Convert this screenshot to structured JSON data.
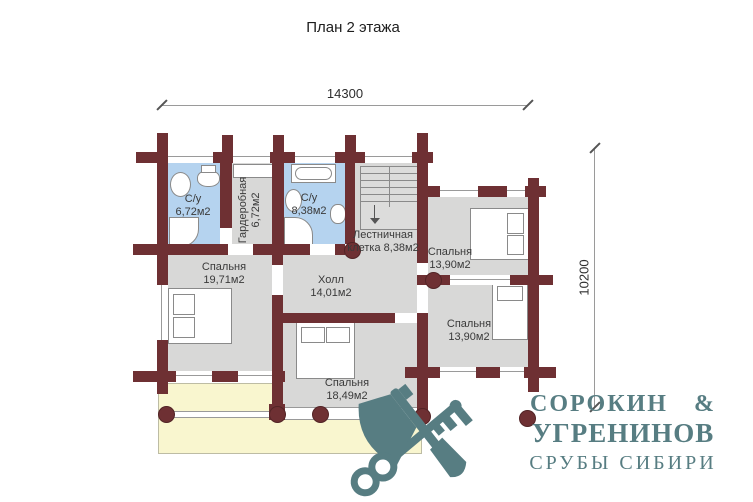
{
  "title": "План 2 этажа",
  "dimensions": {
    "width_label": "14300",
    "height_label": "10200"
  },
  "rooms": {
    "bath1": {
      "name": "С/у",
      "area": "6,72м2"
    },
    "wardrobe": {
      "name": "Гардеробная",
      "area": "6,72м2"
    },
    "bath2": {
      "name": "С/у",
      "area": "8,38м2"
    },
    "stairwell": {
      "line1": "Лестничная",
      "line2": "клетка 8,38м2"
    },
    "bedroom_left": {
      "name": "Спальня",
      "area": "19,71м2"
    },
    "hall": {
      "name": "Холл",
      "area": "14,01м2"
    },
    "bedroom_top_right": {
      "name": "Спальня",
      "area": "13,90м2"
    },
    "bedroom_bottom_right": {
      "name": "Спальня",
      "area": "13,90м2"
    },
    "bedroom_bottom": {
      "name": "Спальня",
      "area": "18,49м2"
    }
  },
  "logo": {
    "line1": "СОРОКИН &",
    "line2": "УГРЕНИНОВ",
    "line3": "СРУБЫ СИБИРИ"
  },
  "colors": {
    "wall": "#6e3033",
    "floor": "#d8d8d7",
    "bathroom": "#b5d3ef",
    "balcony": "#f9f6cf",
    "logo": "#577d82",
    "fixture_outline": "#8a8a8a"
  }
}
